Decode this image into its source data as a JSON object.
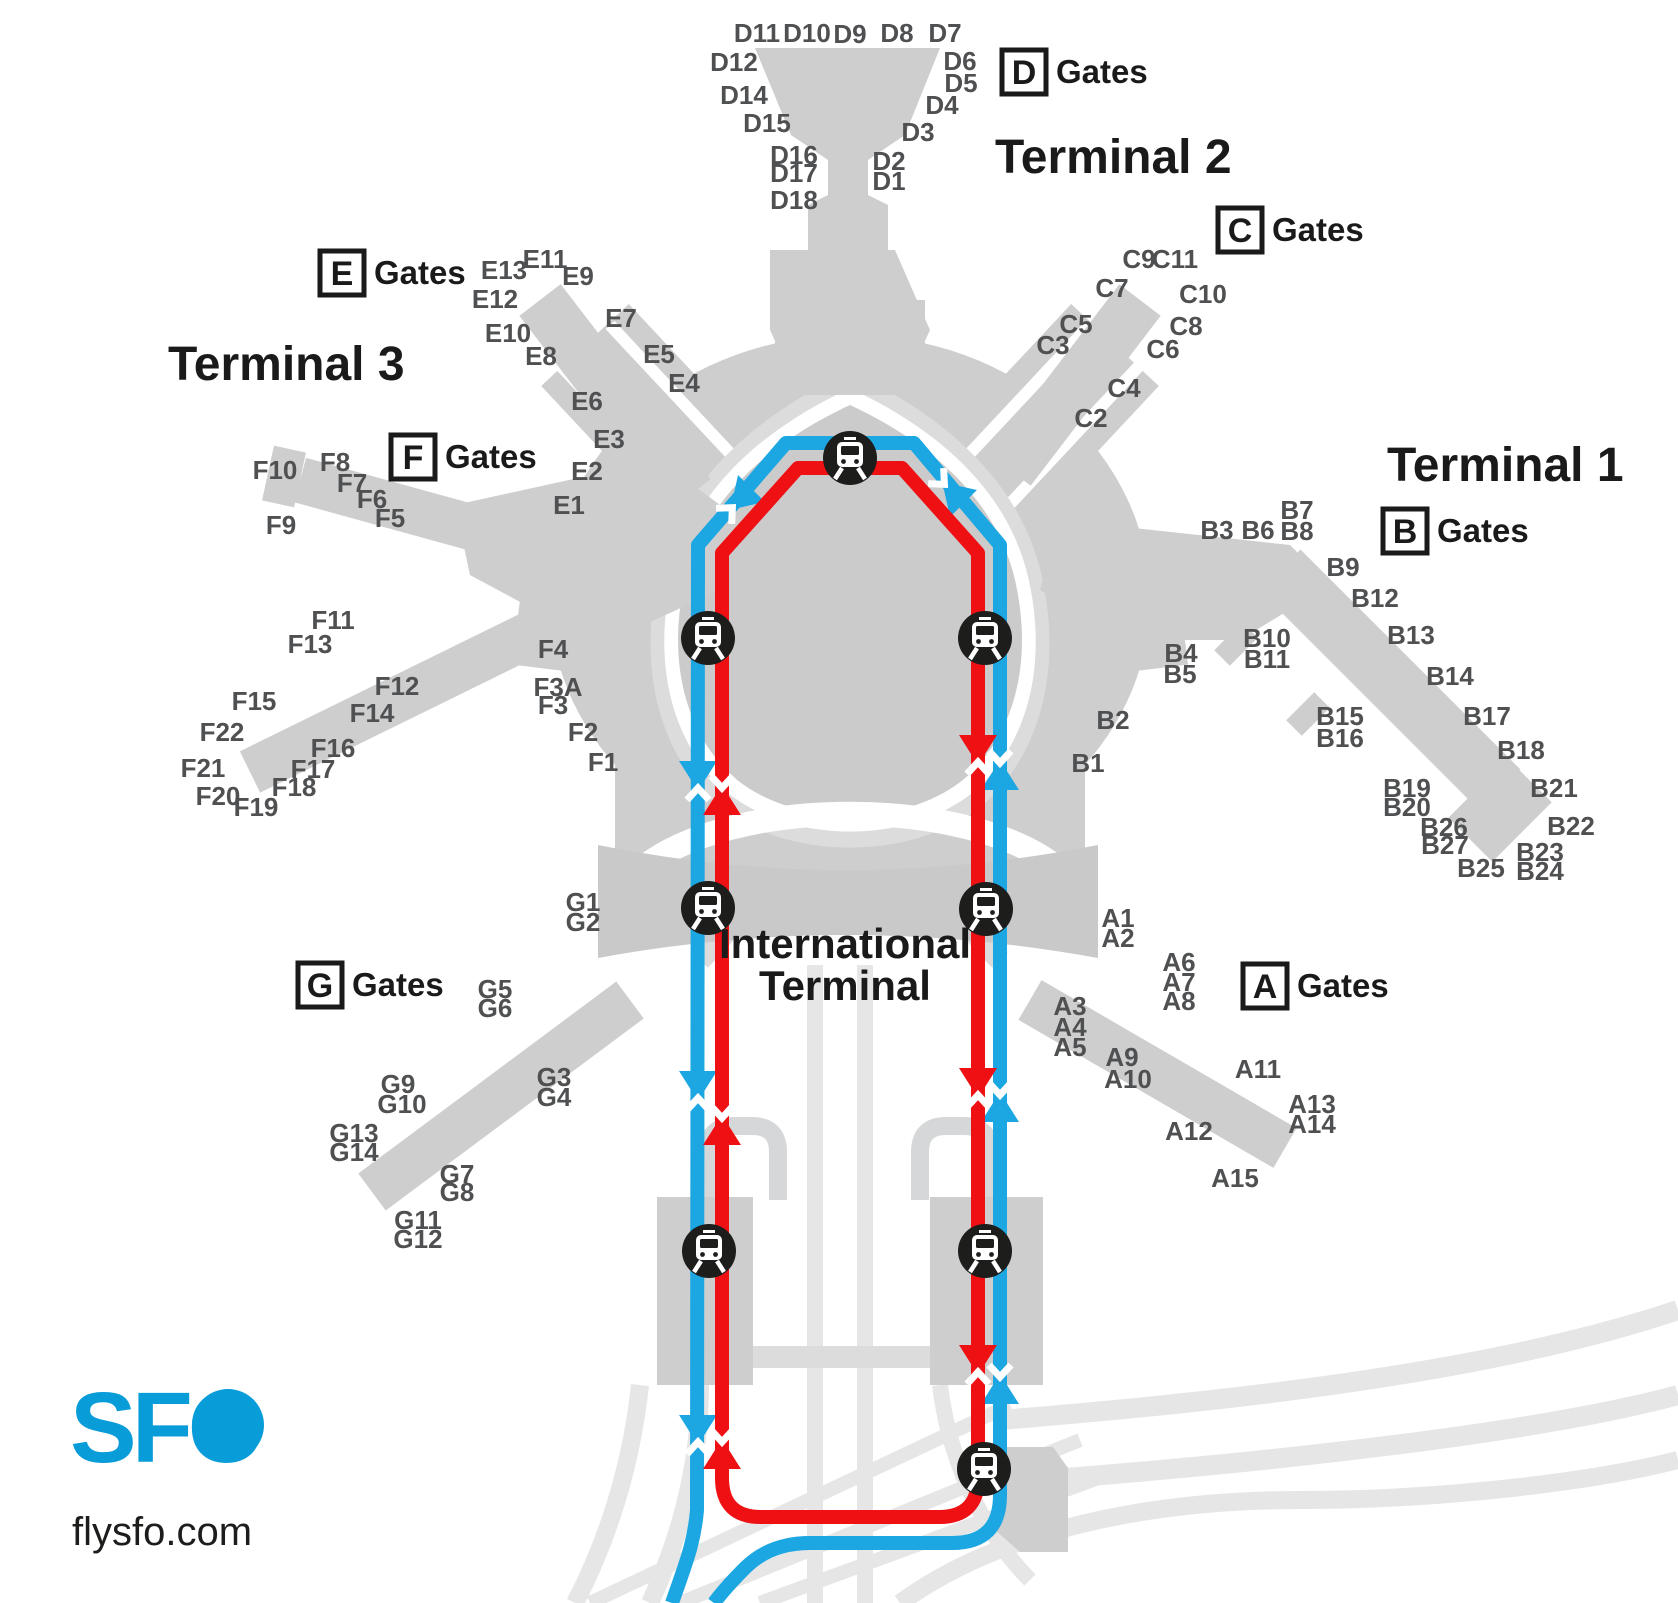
{
  "page": {
    "logo": "SFO",
    "website": "flysfo.com"
  },
  "terminals": {
    "t1": "Terminal 1",
    "t2": "Terminal 2",
    "t3": "Terminal 3",
    "intl_line1": "International",
    "intl_line2": "Terminal"
  },
  "transit": {
    "line_blue": "#1ca7e2",
    "line_red": "#ef1013",
    "station_color": "#1d1d1b"
  },
  "colors": {
    "building_gray": "#cecece",
    "courtyard_gray": "#cbcbcc",
    "road_gray": "#e6e6e7",
    "label_gray": "#4f5052",
    "logo_blue": "#089cd8"
  },
  "gate_groups": [
    {
      "letter": "D",
      "label": "Gates",
      "gates": [
        {
          "id": "D11",
          "x": 757,
          "y": 33
        },
        {
          "id": "D10",
          "x": 807,
          "y": 33
        },
        {
          "id": "D9",
          "x": 850,
          "y": 34
        },
        {
          "id": "D8",
          "x": 897,
          "y": 33
        },
        {
          "id": "D7",
          "x": 945,
          "y": 33
        },
        {
          "id": "D12",
          "x": 734,
          "y": 62
        },
        {
          "id": "D6",
          "x": 960,
          "y": 61
        },
        {
          "id": "D5",
          "x": 961,
          "y": 83
        },
        {
          "id": "D14",
          "x": 744,
          "y": 95
        },
        {
          "id": "D4",
          "x": 942,
          "y": 105
        },
        {
          "id": "D15",
          "x": 767,
          "y": 123
        },
        {
          "id": "D3",
          "x": 918,
          "y": 132
        },
        {
          "id": "D16",
          "x": 794,
          "y": 155
        },
        {
          "id": "D2",
          "x": 889,
          "y": 161
        },
        {
          "id": "D17",
          "x": 794,
          "y": 173
        },
        {
          "id": "D1",
          "x": 889,
          "y": 181
        },
        {
          "id": "D18",
          "x": 794,
          "y": 200
        }
      ]
    },
    {
      "letter": "C",
      "label": "Gates",
      "gates": [
        {
          "id": "C9",
          "x": 1139,
          "y": 259
        },
        {
          "id": "C11",
          "x": 1175,
          "y": 259
        },
        {
          "id": "C7",
          "x": 1112,
          "y": 288
        },
        {
          "id": "C10",
          "x": 1203,
          "y": 294
        },
        {
          "id": "C5",
          "x": 1076,
          "y": 324
        },
        {
          "id": "C8",
          "x": 1186,
          "y": 326
        },
        {
          "id": "C3",
          "x": 1053,
          "y": 345
        },
        {
          "id": "C6",
          "x": 1163,
          "y": 349
        },
        {
          "id": "C4",
          "x": 1124,
          "y": 388
        },
        {
          "id": "C2",
          "x": 1091,
          "y": 418
        }
      ]
    },
    {
      "letter": "E",
      "label": "Gates",
      "gates": [
        {
          "id": "E13",
          "x": 504,
          "y": 270
        },
        {
          "id": "E11",
          "x": 545,
          "y": 259
        },
        {
          "id": "E9",
          "x": 578,
          "y": 276
        },
        {
          "id": "E12",
          "x": 495,
          "y": 299
        },
        {
          "id": "E10",
          "x": 508,
          "y": 333
        },
        {
          "id": "E8",
          "x": 541,
          "y": 356
        },
        {
          "id": "E7",
          "x": 621,
          "y": 318
        },
        {
          "id": "E5",
          "x": 659,
          "y": 354
        },
        {
          "id": "E4",
          "x": 684,
          "y": 383
        },
        {
          "id": "E6",
          "x": 587,
          "y": 401
        },
        {
          "id": "E3",
          "x": 609,
          "y": 439
        },
        {
          "id": "E2",
          "x": 587,
          "y": 471
        },
        {
          "id": "E1",
          "x": 569,
          "y": 505
        }
      ]
    },
    {
      "letter": "F",
      "label": "Gates",
      "gates": [
        {
          "id": "F10",
          "x": 275,
          "y": 470
        },
        {
          "id": "F8",
          "x": 335,
          "y": 462
        },
        {
          "id": "F7",
          "x": 352,
          "y": 483
        },
        {
          "id": "F6",
          "x": 372,
          "y": 499
        },
        {
          "id": "F5",
          "x": 390,
          "y": 518
        },
        {
          "id": "F9",
          "x": 281,
          "y": 525
        },
        {
          "id": "F11",
          "x": 333,
          "y": 620
        },
        {
          "id": "F13",
          "x": 310,
          "y": 644
        },
        {
          "id": "F15",
          "x": 254,
          "y": 701
        },
        {
          "id": "F22",
          "x": 222,
          "y": 732
        },
        {
          "id": "F21",
          "x": 203,
          "y": 768
        },
        {
          "id": "F20",
          "x": 218,
          "y": 796
        },
        {
          "id": "F19",
          "x": 256,
          "y": 807
        },
        {
          "id": "F18",
          "x": 294,
          "y": 787
        },
        {
          "id": "F17",
          "x": 313,
          "y": 769
        },
        {
          "id": "F16",
          "x": 333,
          "y": 748
        },
        {
          "id": "F14",
          "x": 372,
          "y": 713
        },
        {
          "id": "F12",
          "x": 397,
          "y": 686
        },
        {
          "id": "F4",
          "x": 553,
          "y": 649
        },
        {
          "id": "F3A",
          "x": 558,
          "y": 687
        },
        {
          "id": "F3",
          "x": 553,
          "y": 705
        },
        {
          "id": "F2",
          "x": 583,
          "y": 732
        },
        {
          "id": "F1",
          "x": 603,
          "y": 762
        }
      ]
    },
    {
      "letter": "B",
      "label": "Gates",
      "gates": [
        {
          "id": "B3",
          "x": 1217,
          "y": 530
        },
        {
          "id": "B6",
          "x": 1258,
          "y": 530
        },
        {
          "id": "B7",
          "x": 1297,
          "y": 510
        },
        {
          "id": "B8",
          "x": 1297,
          "y": 531
        },
        {
          "id": "B9",
          "x": 1343,
          "y": 567
        },
        {
          "id": "B12",
          "x": 1375,
          "y": 598
        },
        {
          "id": "B13",
          "x": 1411,
          "y": 635
        },
        {
          "id": "B14",
          "x": 1450,
          "y": 676
        },
        {
          "id": "B17",
          "x": 1487,
          "y": 716
        },
        {
          "id": "B18",
          "x": 1521,
          "y": 750
        },
        {
          "id": "B21",
          "x": 1554,
          "y": 788
        },
        {
          "id": "B22",
          "x": 1571,
          "y": 826
        },
        {
          "id": "B23",
          "x": 1540,
          "y": 852
        },
        {
          "id": "B24",
          "x": 1540,
          "y": 871
        },
        {
          "id": "B25",
          "x": 1481,
          "y": 868
        },
        {
          "id": "B26",
          "x": 1444,
          "y": 827
        },
        {
          "id": "B27",
          "x": 1445,
          "y": 845
        },
        {
          "id": "B19",
          "x": 1407,
          "y": 788
        },
        {
          "id": "B20",
          "x": 1407,
          "y": 807
        },
        {
          "id": "B15",
          "x": 1340,
          "y": 716
        },
        {
          "id": "B16",
          "x": 1340,
          "y": 738
        },
        {
          "id": "B10",
          "x": 1267,
          "y": 638
        },
        {
          "id": "B11",
          "x": 1267,
          "y": 659
        },
        {
          "id": "B4",
          "x": 1181,
          "y": 653
        },
        {
          "id": "B5",
          "x": 1180,
          "y": 674
        },
        {
          "id": "B2",
          "x": 1113,
          "y": 720
        },
        {
          "id": "B1",
          "x": 1088,
          "y": 763
        }
      ]
    },
    {
      "letter": "A",
      "label": "Gates",
      "gates": [
        {
          "id": "A1",
          "x": 1118,
          "y": 918
        },
        {
          "id": "A2",
          "x": 1118,
          "y": 938
        },
        {
          "id": "A6",
          "x": 1179,
          "y": 962
        },
        {
          "id": "A7",
          "x": 1179,
          "y": 982
        },
        {
          "id": "A8",
          "x": 1179,
          "y": 1001
        },
        {
          "id": "A3",
          "x": 1070,
          "y": 1006
        },
        {
          "id": "A4",
          "x": 1070,
          "y": 1027
        },
        {
          "id": "A5",
          "x": 1070,
          "y": 1047
        },
        {
          "id": "A9",
          "x": 1122,
          "y": 1057
        },
        {
          "id": "A10",
          "x": 1128,
          "y": 1079
        },
        {
          "id": "A11",
          "x": 1258,
          "y": 1069
        },
        {
          "id": "A13",
          "x": 1312,
          "y": 1104
        },
        {
          "id": "A14",
          "x": 1312,
          "y": 1124
        },
        {
          "id": "A12",
          "x": 1189,
          "y": 1131
        },
        {
          "id": "A15",
          "x": 1235,
          "y": 1178
        }
      ]
    },
    {
      "letter": "G",
      "label": "Gates",
      "gates": [
        {
          "id": "G1",
          "x": 583,
          "y": 902
        },
        {
          "id": "G2",
          "x": 583,
          "y": 922
        },
        {
          "id": "G5",
          "x": 495,
          "y": 989
        },
        {
          "id": "G6",
          "x": 495,
          "y": 1008
        },
        {
          "id": "G3",
          "x": 554,
          "y": 1077
        },
        {
          "id": "G4",
          "x": 554,
          "y": 1097
        },
        {
          "id": "G9",
          "x": 398,
          "y": 1084
        },
        {
          "id": "G10",
          "x": 402,
          "y": 1104
        },
        {
          "id": "G13",
          "x": 354,
          "y": 1133
        },
        {
          "id": "G14",
          "x": 354,
          "y": 1152
        },
        {
          "id": "G7",
          "x": 457,
          "y": 1174
        },
        {
          "id": "G8",
          "x": 457,
          "y": 1192
        },
        {
          "id": "G11",
          "x": 418,
          "y": 1220
        },
        {
          "id": "G12",
          "x": 418,
          "y": 1239
        }
      ]
    }
  ]
}
